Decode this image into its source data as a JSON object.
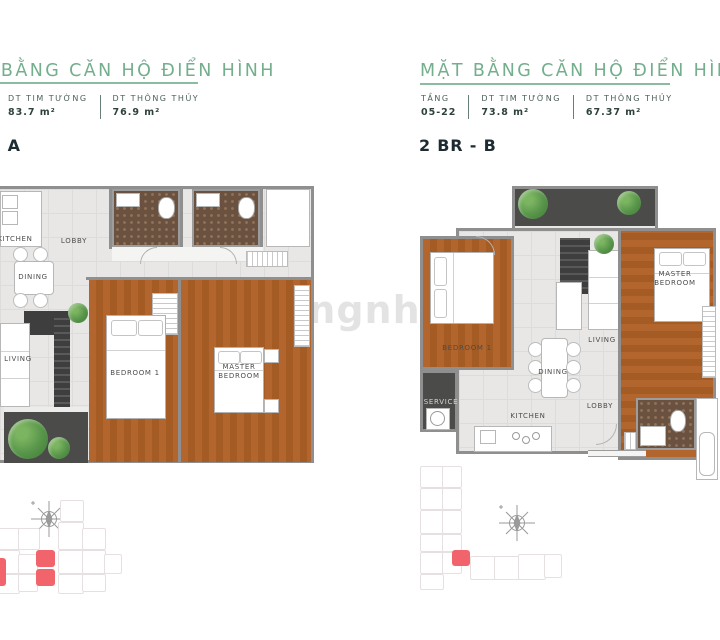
{
  "watermark": "sangnhuong",
  "panels": [
    {
      "title": "MẶT BẰNG CĂN HỘ ĐIỂN HÌNH",
      "unit_label": "2 BR - A",
      "stats": [
        {
          "label": "DT TIM TƯỜNG",
          "value": "83.7 m²"
        },
        {
          "label": "DT THÔNG THỦY",
          "value": "76.9 m²"
        }
      ],
      "rooms": [
        {
          "name": "KITCHEN"
        },
        {
          "name": "LOBBY"
        },
        {
          "name": "DINING"
        },
        {
          "name": "LIVING"
        },
        {
          "name": "BEDROOM 1"
        },
        {
          "name": "MASTER BEDROOM"
        }
      ]
    },
    {
      "title": "MẶT BẰNG CĂN HỘ ĐIỂN HÌNH",
      "unit_label": "2 BR - B",
      "stats": [
        {
          "label": "TẦNG",
          "value": "05-22"
        },
        {
          "label": "DT TIM TƯỜNG",
          "value": "73.8 m²"
        },
        {
          "label": "DT THÔNG THỦY",
          "value": "67.37 m²"
        }
      ],
      "rooms": [
        {
          "name": "BEDROOM 1"
        },
        {
          "name": "LIVING"
        },
        {
          "name": "MASTER BEDROOM"
        },
        {
          "name": "SERVICE"
        },
        {
          "name": "DINING"
        },
        {
          "name": "KITCHEN"
        },
        {
          "name": "LOBBY"
        }
      ]
    }
  ],
  "colors": {
    "accent_green": "#74ae8d",
    "underline_green": "#8cbca0",
    "stat_text": "#4c5f58",
    "unit_text": "#1d2b33",
    "wood_floor": "#b2652c",
    "bathroom_tile": "#6b5140",
    "balcony_floor": "#4b4b49",
    "plant_green": "#58954a",
    "wall_gray": "#8f8f8f",
    "floor_tile": "#e8e7e5",
    "keyplan_highlight": "#f2646c"
  }
}
